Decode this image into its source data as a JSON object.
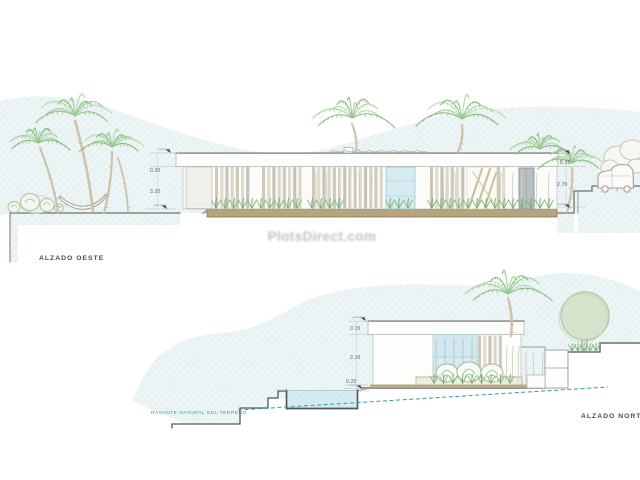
{
  "watermark": {
    "text": "PlotsDirect.com"
  },
  "west_elevation": {
    "label": "ALZADO OESTE",
    "dim_fascia_left": "0.35",
    "dim_wall_left": "3.30",
    "dim_fascia_right": "0.35",
    "dim_clear_right": "2.70"
  },
  "north_elevation": {
    "label": "ALZADO NORTE",
    "terrain_note": "RASANTE NATURAL DEL TERRENO",
    "dim_fascia": "0.35",
    "dim_wall": "3.30",
    "dim_plinth": "0.25"
  },
  "colors": {
    "hatch_bg": "#eef5f6",
    "hatch_line": "#d7e9eb",
    "glass": "#d8ecf1",
    "glass_line": "#bfdfe7",
    "water": "#d4eaf0",
    "ground_tan": "#b5a47d",
    "ground_dark": "#857550",
    "outline": "#83837e",
    "teal": "#2aa396",
    "label": "#4d4d4d",
    "dim": "#5f5f5b",
    "palm_green": "#9ccb93",
    "trunk": "#cfc3aa",
    "watermark_gray": "#7d858c"
  }
}
